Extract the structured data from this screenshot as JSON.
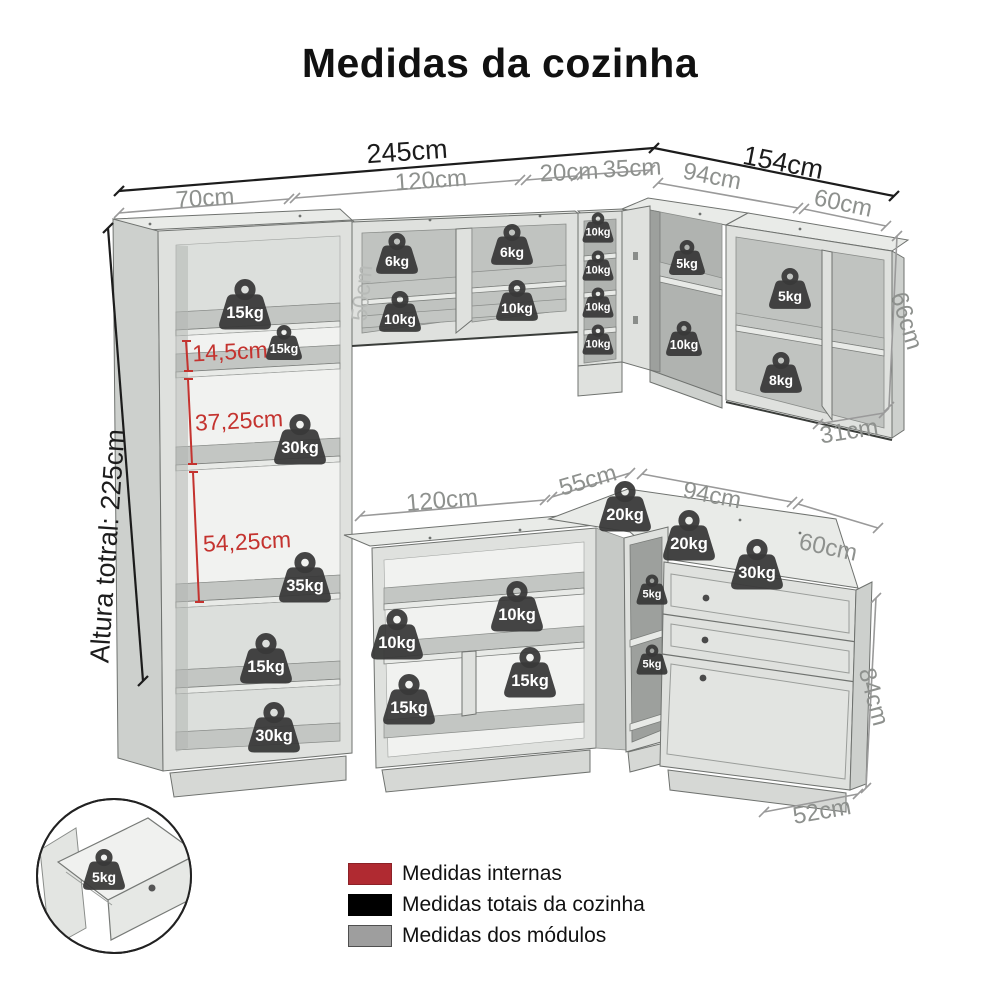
{
  "title": "Medidas da cozinha",
  "dimensions": {
    "total": {
      "left_width": "245cm",
      "right_width": "154cm",
      "height": "Altura totral: 225cm"
    },
    "modules": {
      "top_left": "70cm",
      "top_mid": "120cm",
      "top_narrow": "20cm",
      "top_corner": "35cm",
      "top_right_a": "94cm",
      "top_right_b": "60cm",
      "wall_height": "66cm",
      "wall_depth": "31cm",
      "wall_mid_height": "50cm",
      "base_mid": "120cm",
      "base_corner": "55cm",
      "base_right_a": "94cm",
      "base_right_b": "60cm",
      "base_height": "84cm",
      "base_depth": "52cm"
    },
    "internal": {
      "shelf_small": "14,5cm",
      "shelf_mid": "37,25cm",
      "shelf_large": "54,25cm"
    }
  },
  "weights": [
    {
      "label": "15kg",
      "location": "tall-cabinet-shelf-1"
    },
    {
      "label": "15kg",
      "location": "tall-cabinet-shelf-2"
    },
    {
      "label": "30kg",
      "location": "tall-cabinet-shelf-3"
    },
    {
      "label": "35kg",
      "location": "tall-cabinet-shelf-4"
    },
    {
      "label": "15kg",
      "location": "tall-cabinet-shelf-5"
    },
    {
      "label": "30kg",
      "location": "tall-cabinet-base"
    },
    {
      "label": "6kg",
      "location": "wall-cabinet-left-top"
    },
    {
      "label": "10kg",
      "location": "wall-cabinet-left-bottom"
    },
    {
      "label": "6kg",
      "location": "wall-cabinet-right-top"
    },
    {
      "label": "10kg",
      "location": "wall-cabinet-right-bottom"
    },
    {
      "label": "10kg",
      "location": "niche-shelf-1"
    },
    {
      "label": "10kg",
      "location": "niche-shelf-2"
    },
    {
      "label": "10kg",
      "location": "niche-shelf-3"
    },
    {
      "label": "10kg",
      "location": "niche-shelf-4"
    },
    {
      "label": "5kg",
      "location": "corner-wall-top"
    },
    {
      "label": "10kg",
      "location": "corner-wall-bottom"
    },
    {
      "label": "5kg",
      "location": "right-wall-shelf"
    },
    {
      "label": "8kg",
      "location": "right-wall-bottom"
    },
    {
      "label": "20kg",
      "location": "corner-countertop-left"
    },
    {
      "label": "20kg",
      "location": "corner-countertop-right"
    },
    {
      "label": "30kg",
      "location": "drawer-unit-top"
    },
    {
      "label": "10kg",
      "location": "base-cabinet-left-shelf"
    },
    {
      "label": "10kg",
      "location": "base-cabinet-right-shelf"
    },
    {
      "label": "15kg",
      "location": "base-cabinet-right-bottom"
    },
    {
      "label": "15kg",
      "location": "base-cabinet-left-bottom"
    },
    {
      "label": "5kg",
      "location": "corner-base-top"
    },
    {
      "label": "5kg",
      "location": "corner-base-bottom"
    },
    {
      "label": "5kg",
      "location": "drawer-detail-inset"
    }
  ],
  "legend": {
    "items": [
      {
        "label": "Medidas internas",
        "color": "#b02a31"
      },
      {
        "label": "Medidas totais da cozinha",
        "color": "#000000"
      },
      {
        "label": "Medidas dos módulos",
        "color": "#9e9e9e"
      }
    ]
  }
}
